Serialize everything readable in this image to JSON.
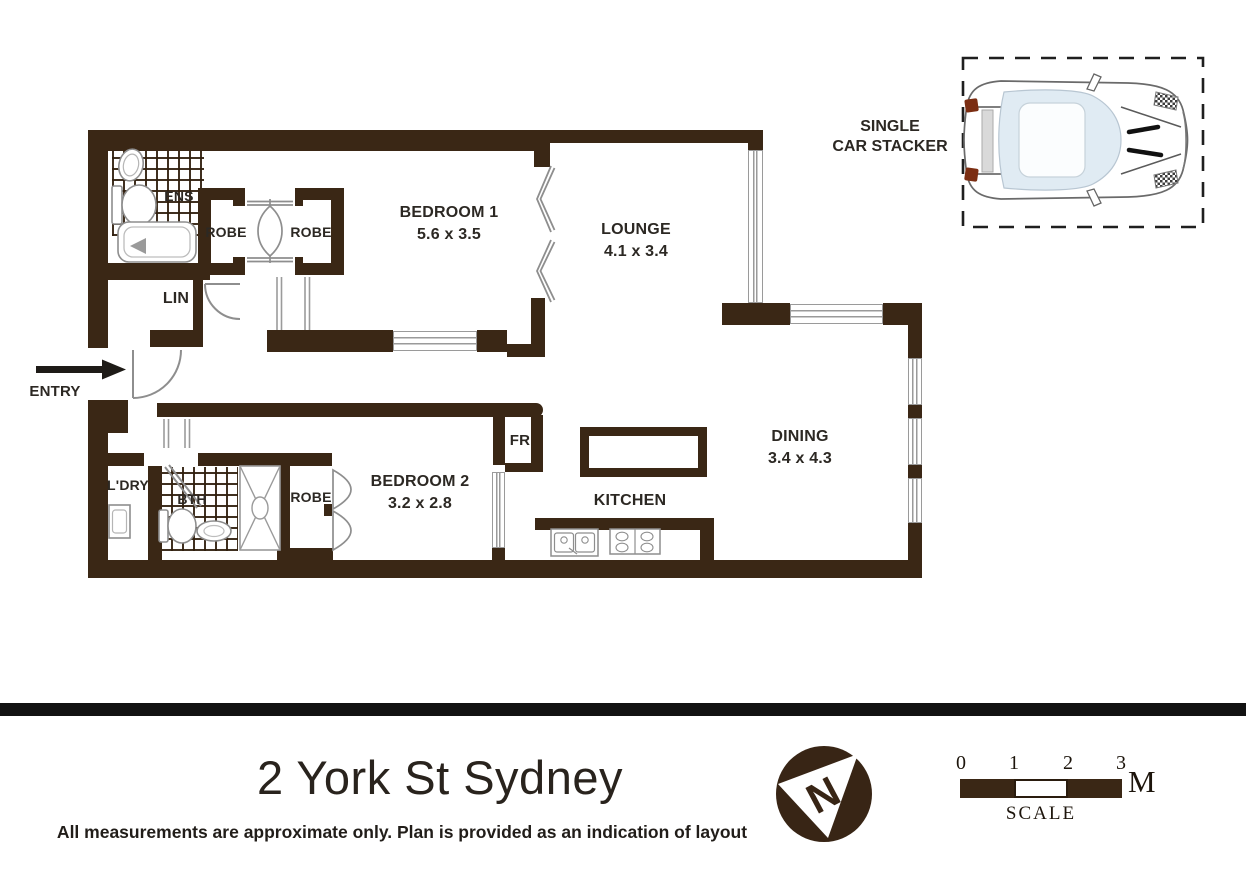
{
  "plan": {
    "entry_label": "ENTRY",
    "rooms": {
      "bedroom1": {
        "name": "BEDROOM 1",
        "dims": "5.6 x 3.5"
      },
      "lounge": {
        "name": "LOUNGE",
        "dims": "4.1 x 3.4"
      },
      "dining": {
        "name": "DINING",
        "dims": "3.4 x 4.3"
      },
      "kitchen": {
        "name": "KITCHEN"
      },
      "bedroom2": {
        "name": "BEDROOM 2",
        "dims": "3.2 x 2.8"
      },
      "ens": {
        "name": "ENS"
      },
      "lin": {
        "name": "LIN"
      },
      "ldry": {
        "name": "L'DRY"
      },
      "bth": {
        "name": "BTH"
      },
      "robe_b1_left": {
        "name": "ROBE"
      },
      "robe_b1_right": {
        "name": "ROBE"
      },
      "robe_b2": {
        "name": "ROBE"
      },
      "fridge": {
        "name": "FR"
      }
    },
    "car_stacker": {
      "label_line1": "SINGLE",
      "label_line2": "CAR STACKER"
    }
  },
  "footer": {
    "title": "2 York St Sydney",
    "disclaimer": "All measurements are approximate only. Plan is provided as an indication of layout",
    "north": {
      "letter": "N"
    },
    "scale": {
      "ticks": [
        "0",
        "1",
        "2",
        "3"
      ],
      "unit": "M",
      "label": "SCALE"
    }
  },
  "colors": {
    "wall": "#3a2715",
    "plan_line": "#9a9a9a",
    "text": "#2c2823",
    "divider": "#121212"
  }
}
